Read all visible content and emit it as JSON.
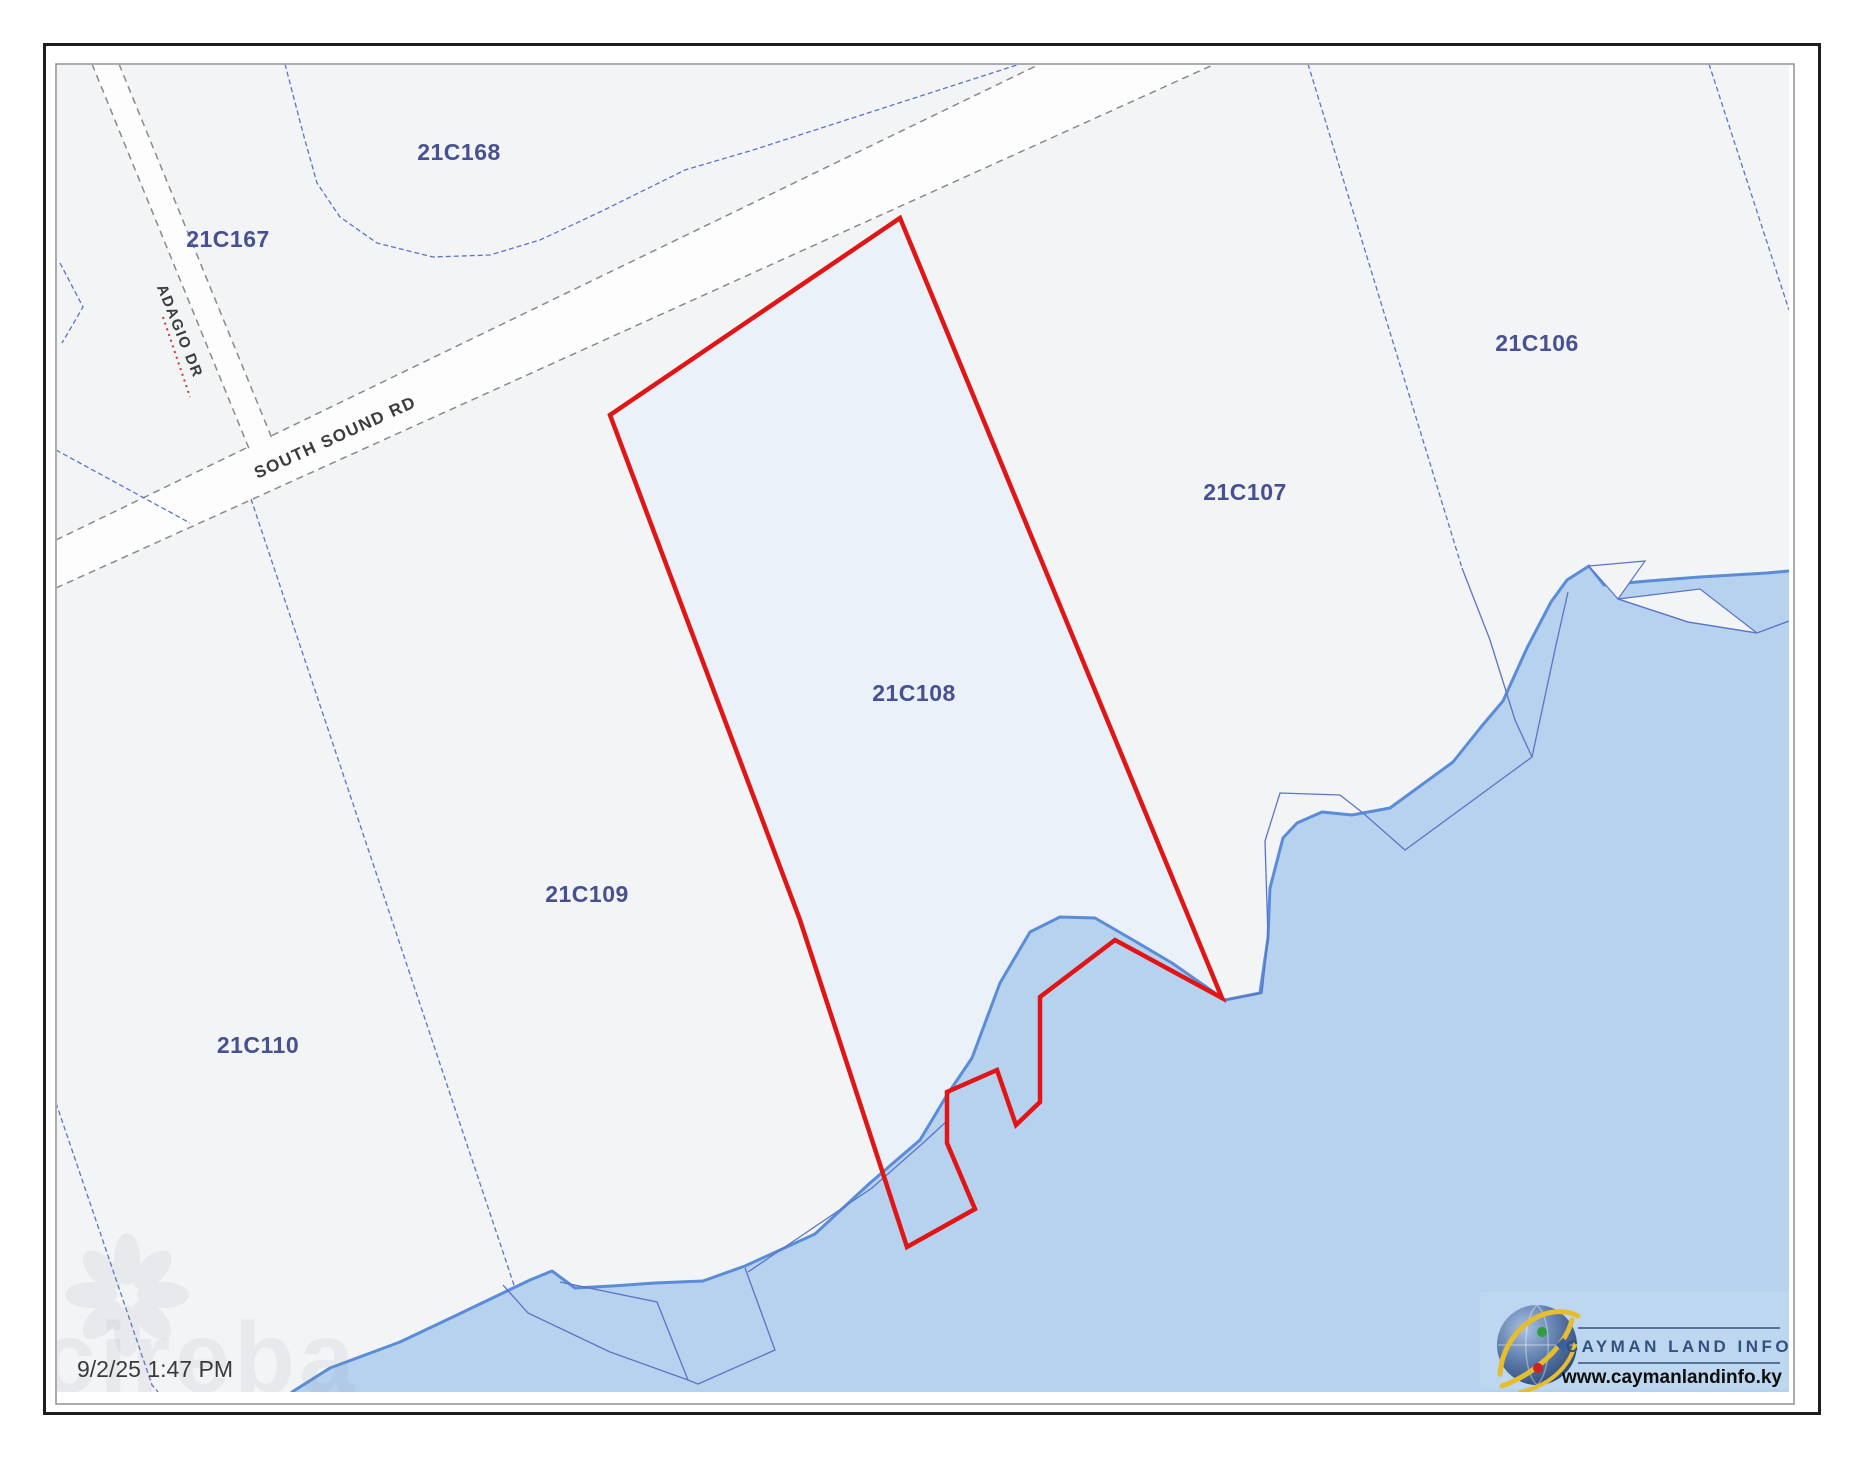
{
  "parcels": [
    {
      "id": "21C168"
    },
    {
      "id": "21C167"
    },
    {
      "id": "21C106"
    },
    {
      "id": "21C107"
    },
    {
      "id": "21C108"
    },
    {
      "id": "21C109"
    },
    {
      "id": "21C110"
    }
  ],
  "selected_parcel": "21C108",
  "roads": [
    {
      "name": "SOUTH SOUND RD"
    },
    {
      "name": "ADAGIO DR"
    }
  ],
  "footer": {
    "timestamp": "9/2/25 1:47 PM"
  },
  "logo": {
    "title": "CAYMAN LAND INFO",
    "url": "www.caymanlandinfo.ky"
  },
  "watermark": {
    "text": "cireba"
  },
  "colors": {
    "selection_outline": "#e01515",
    "water_fill": "#b7d2ee",
    "water_edge": "#5a8cd8",
    "boundary_line": "#5b74c8",
    "parcel_label": "#475093",
    "road_edge": "#8a8a8a",
    "map_background": "#f3f4f6",
    "logo_panel": "#bdd7f0"
  }
}
